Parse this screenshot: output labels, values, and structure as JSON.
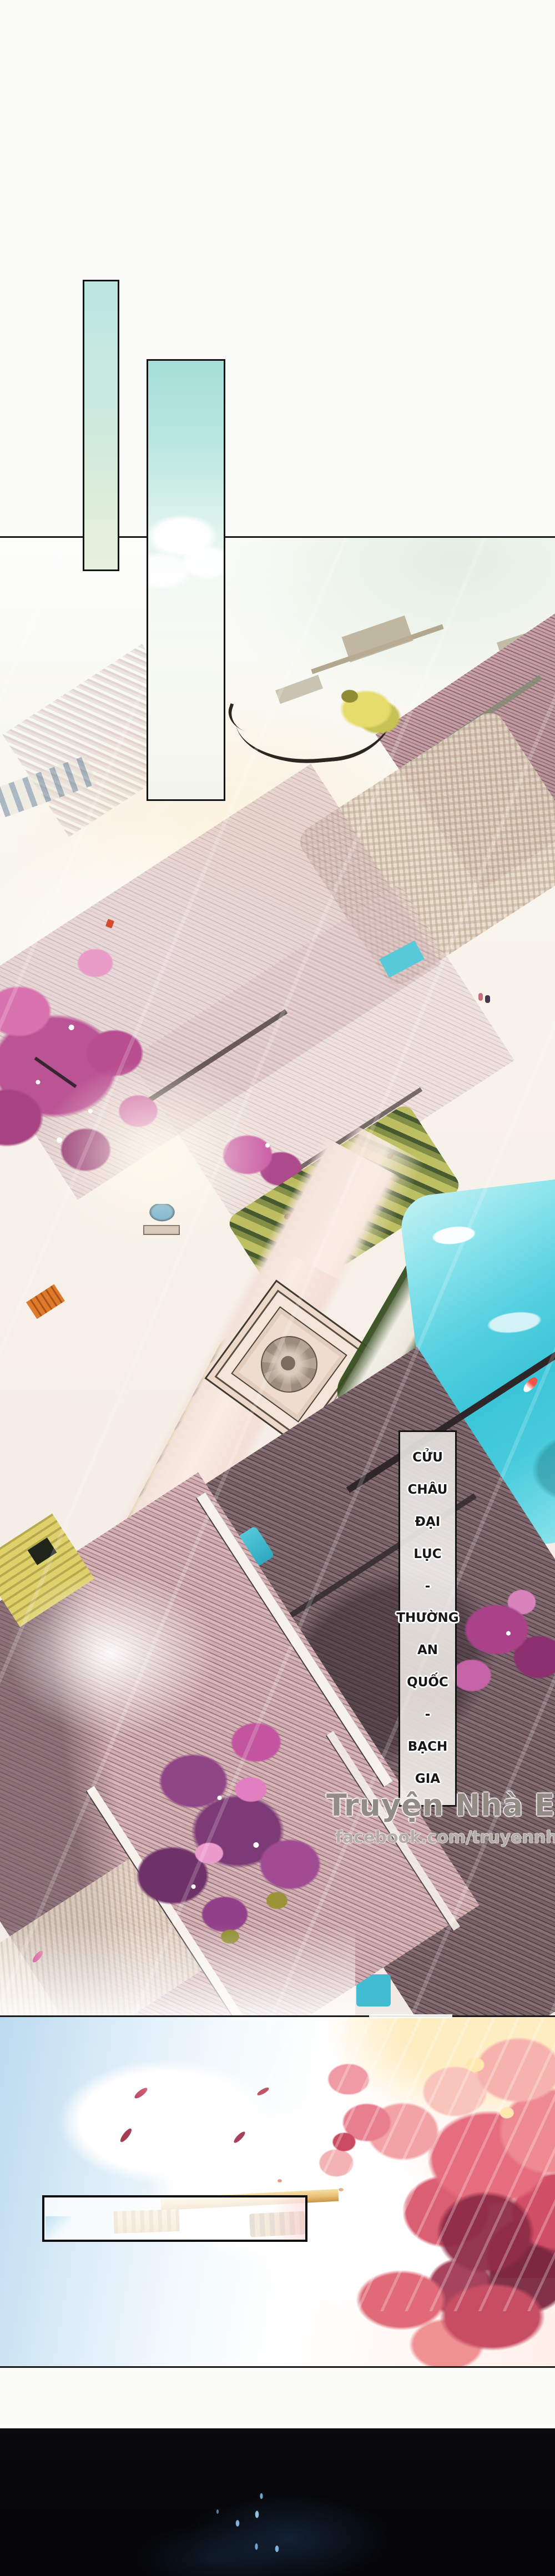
{
  "page": {
    "kind": "manhua-page",
    "description": "Vertical comic page: white header with two tall cyan panels, aerial painting of a traditional estate with blossom trees and a turquoise pond, vertical Vietnamese location caption, translator watermark, sky panel with pink tree and empty caption box, black night strip at bottom."
  },
  "caption": {
    "full_text": "CỬU CHÂU ĐẠI LỤC - THƯỜNG AN QUỐC - BẠCH GIA",
    "lines": [
      "CỬU",
      "CHÂU",
      "ĐẠI",
      "LỤC",
      "-",
      "THƯỜNG",
      "AN",
      "QUỐC",
      "-",
      "BẠCH",
      "GIA"
    ]
  },
  "watermark": {
    "title": "Truyện Nhà Eimi",
    "url": "facebook.com/truyennhaeimi"
  },
  "speech_box": {
    "text": ""
  },
  "palette": {
    "panel_line": "#1b1b1b",
    "bubble_cyan_top": "#aee3dc",
    "bubble_pale_green": "#e7f0dc",
    "mint_sky": "#e3eee1",
    "roof_mauve": "#c9a1a6",
    "roof_dark": "#5d4a51",
    "blossom_pink": "#c95d9f",
    "tree_purple": "#7c3b76",
    "pond_turquoise": "#3cc5d8",
    "koi_red": "#f25545",
    "hedge_olive": "#7f8c40",
    "sky_blue": "#bcdaef",
    "foliage_red": "#e56d7d",
    "gold_beam": "#e9bf72",
    "petal_red": "#a63d52",
    "night_black": "#07070a",
    "sparkle_blue": "#7fb2d9"
  }
}
